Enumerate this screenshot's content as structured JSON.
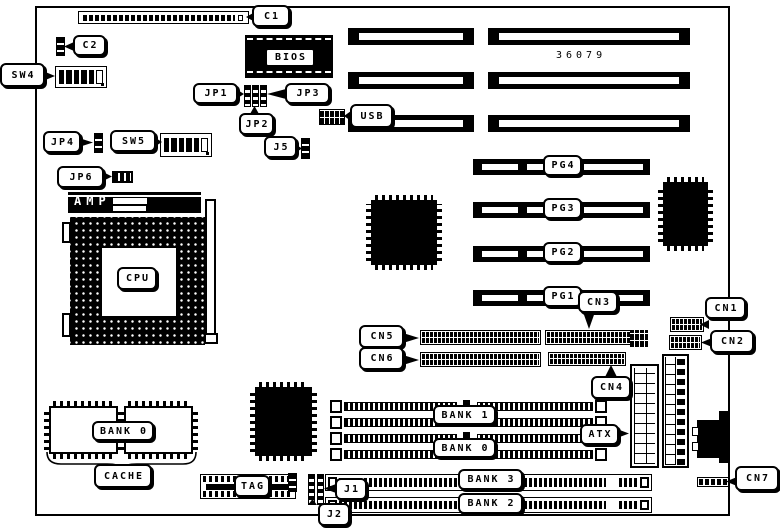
{
  "board": {
    "part_number": "36079"
  },
  "colors": {
    "ink": "#000000",
    "paper": "#ffffff"
  },
  "labels": {
    "c1": "C1",
    "c2": "C2",
    "sw4": "SW4",
    "jp1": "JP1",
    "jp2": "JP2",
    "jp3": "JP3",
    "j5": "J5",
    "jp4": "JP4",
    "sw5": "SW5",
    "jp6": "JP6",
    "bios": "BIOS",
    "usb": "USB",
    "amp": "AMP",
    "cpu": "CPU",
    "pg4": "PG4",
    "pg3": "PG3",
    "pg2": "PG2",
    "pg1": "PG1",
    "cn1": "CN1",
    "cn2": "CN2",
    "cn3": "CN3",
    "cn4": "CN4",
    "cn5": "CN5",
    "cn6": "CN6",
    "cn7": "CN7",
    "atx": "ATX",
    "j1": "J1",
    "j2": "J2",
    "bank1": "BANK 1",
    "bank0_simm": "BANK 0",
    "bank3": "BANK 3",
    "bank2": "BANK 2",
    "bank0_cache": "BANK 0",
    "cache": "CACHE",
    "tag": "TAG"
  }
}
